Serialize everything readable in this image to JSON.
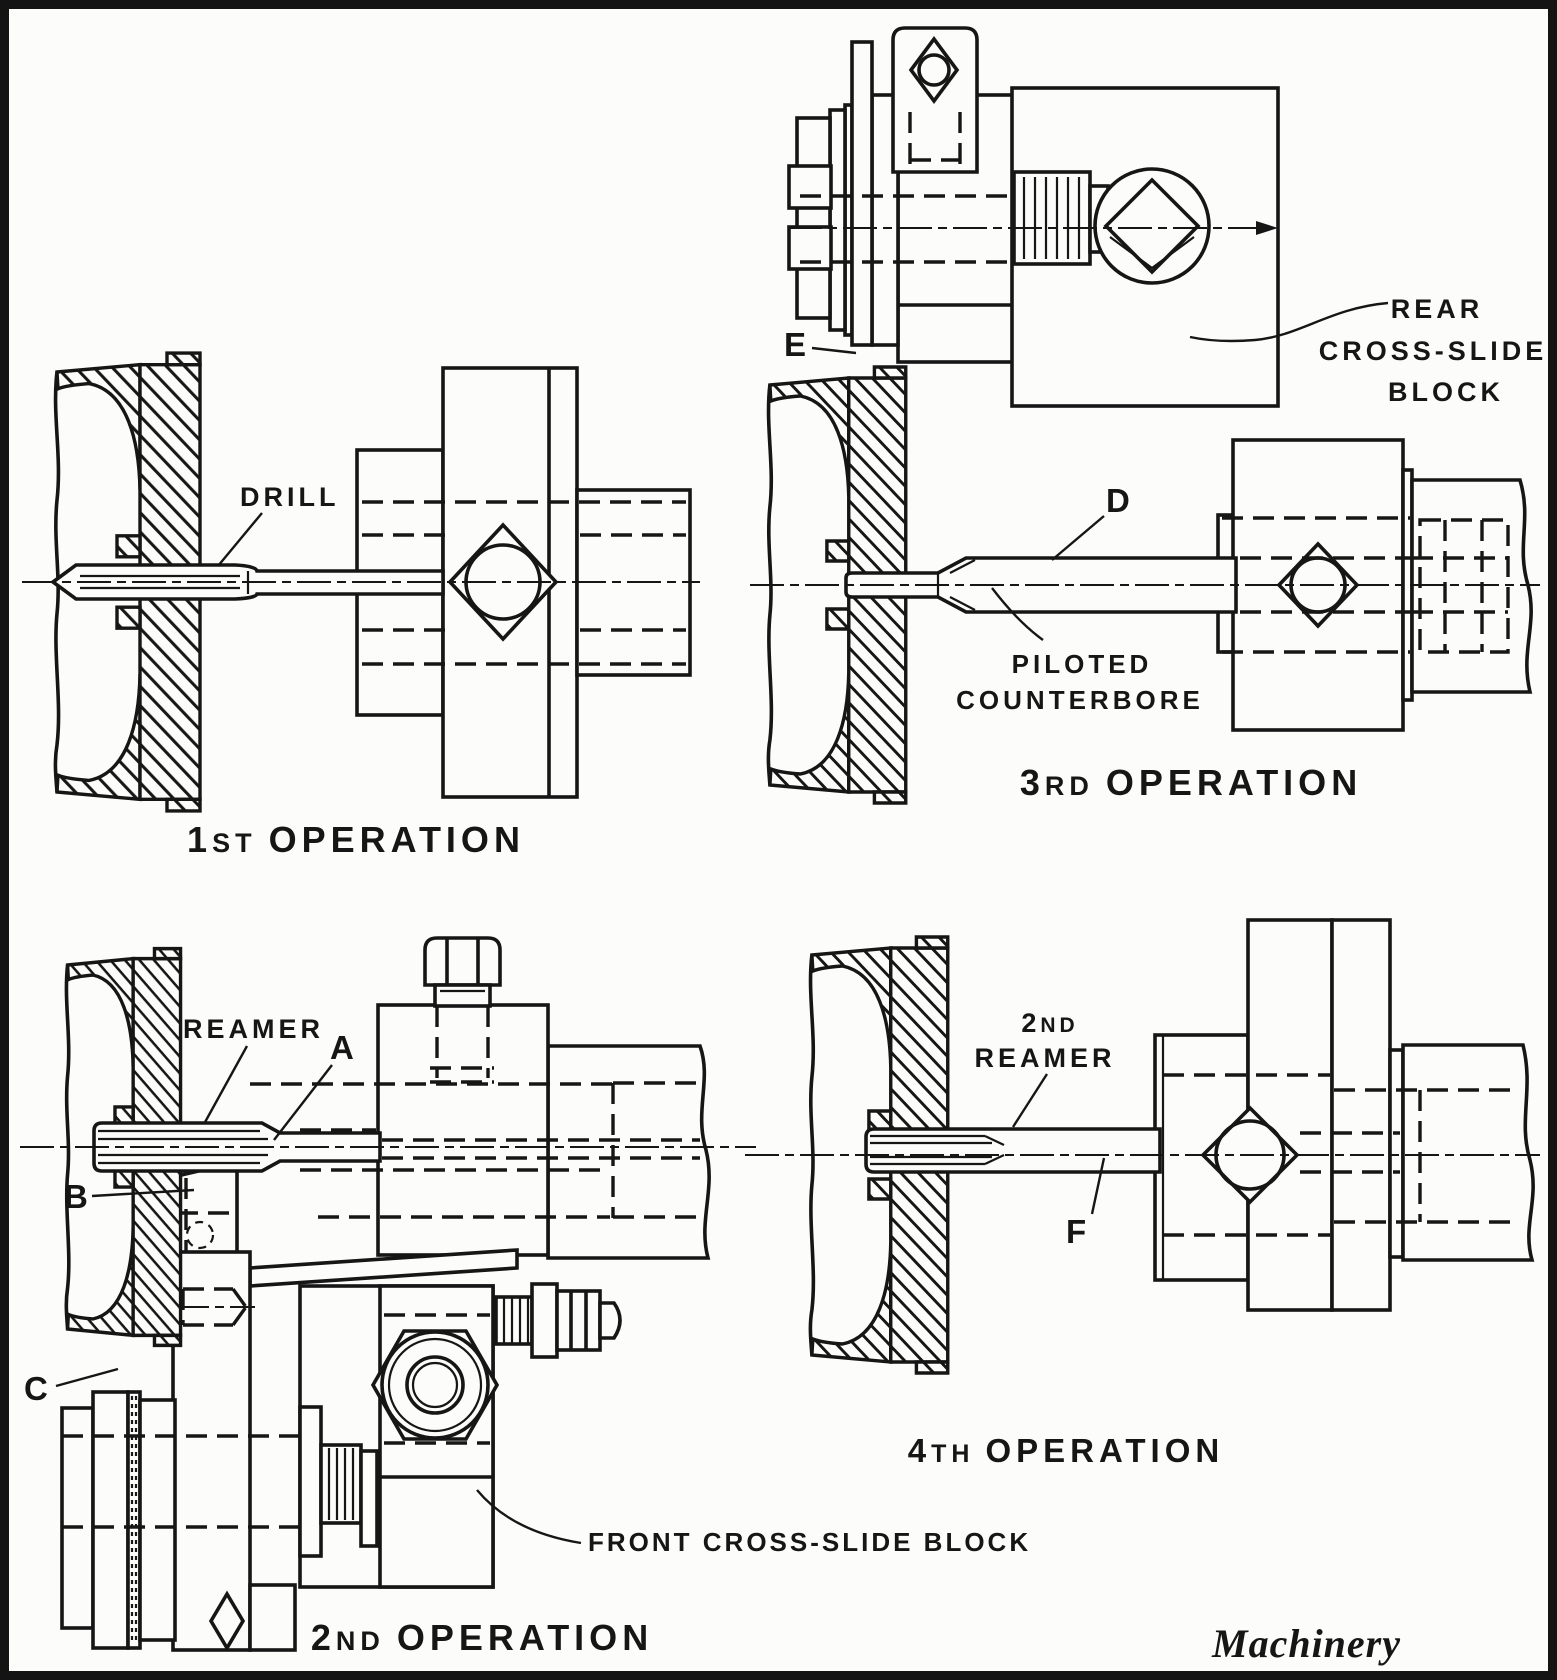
{
  "document": {
    "type": "technical-figure",
    "credit": "Machinery",
    "ink_color": "#161616",
    "paper_color": "#fcfcfa"
  },
  "panels": {
    "op1": {
      "caption": {
        "number": "1",
        "ordinal": "ST",
        "word": "OPERATION"
      },
      "labels": {
        "drill": "DRILL"
      }
    },
    "op2": {
      "caption": {
        "number": "2",
        "ordinal": "ND",
        "word": "OPERATION"
      },
      "labels": {
        "reamer": "REAMER",
        "a": "A",
        "b": "B",
        "c": "C",
        "front_block": "FRONT CROSS-SLIDE BLOCK"
      }
    },
    "op3": {
      "caption": {
        "number": "3",
        "ordinal": "RD",
        "word": "OPERATION"
      },
      "labels": {
        "d": "D",
        "e": "E",
        "piloted_line1": "PILOTED",
        "piloted_line2": "COUNTERBORE",
        "rear_line1": "REAR",
        "rear_line2": "CROSS-SLIDE",
        "rear_line3": "BLOCK"
      }
    },
    "op4": {
      "caption": {
        "number": "4",
        "ordinal": "TH",
        "word": "OPERATION"
      },
      "labels": {
        "reamer2_number": "2",
        "reamer2_ordinal": "ND",
        "reamer2_word": "REAMER",
        "f": "F"
      }
    }
  }
}
